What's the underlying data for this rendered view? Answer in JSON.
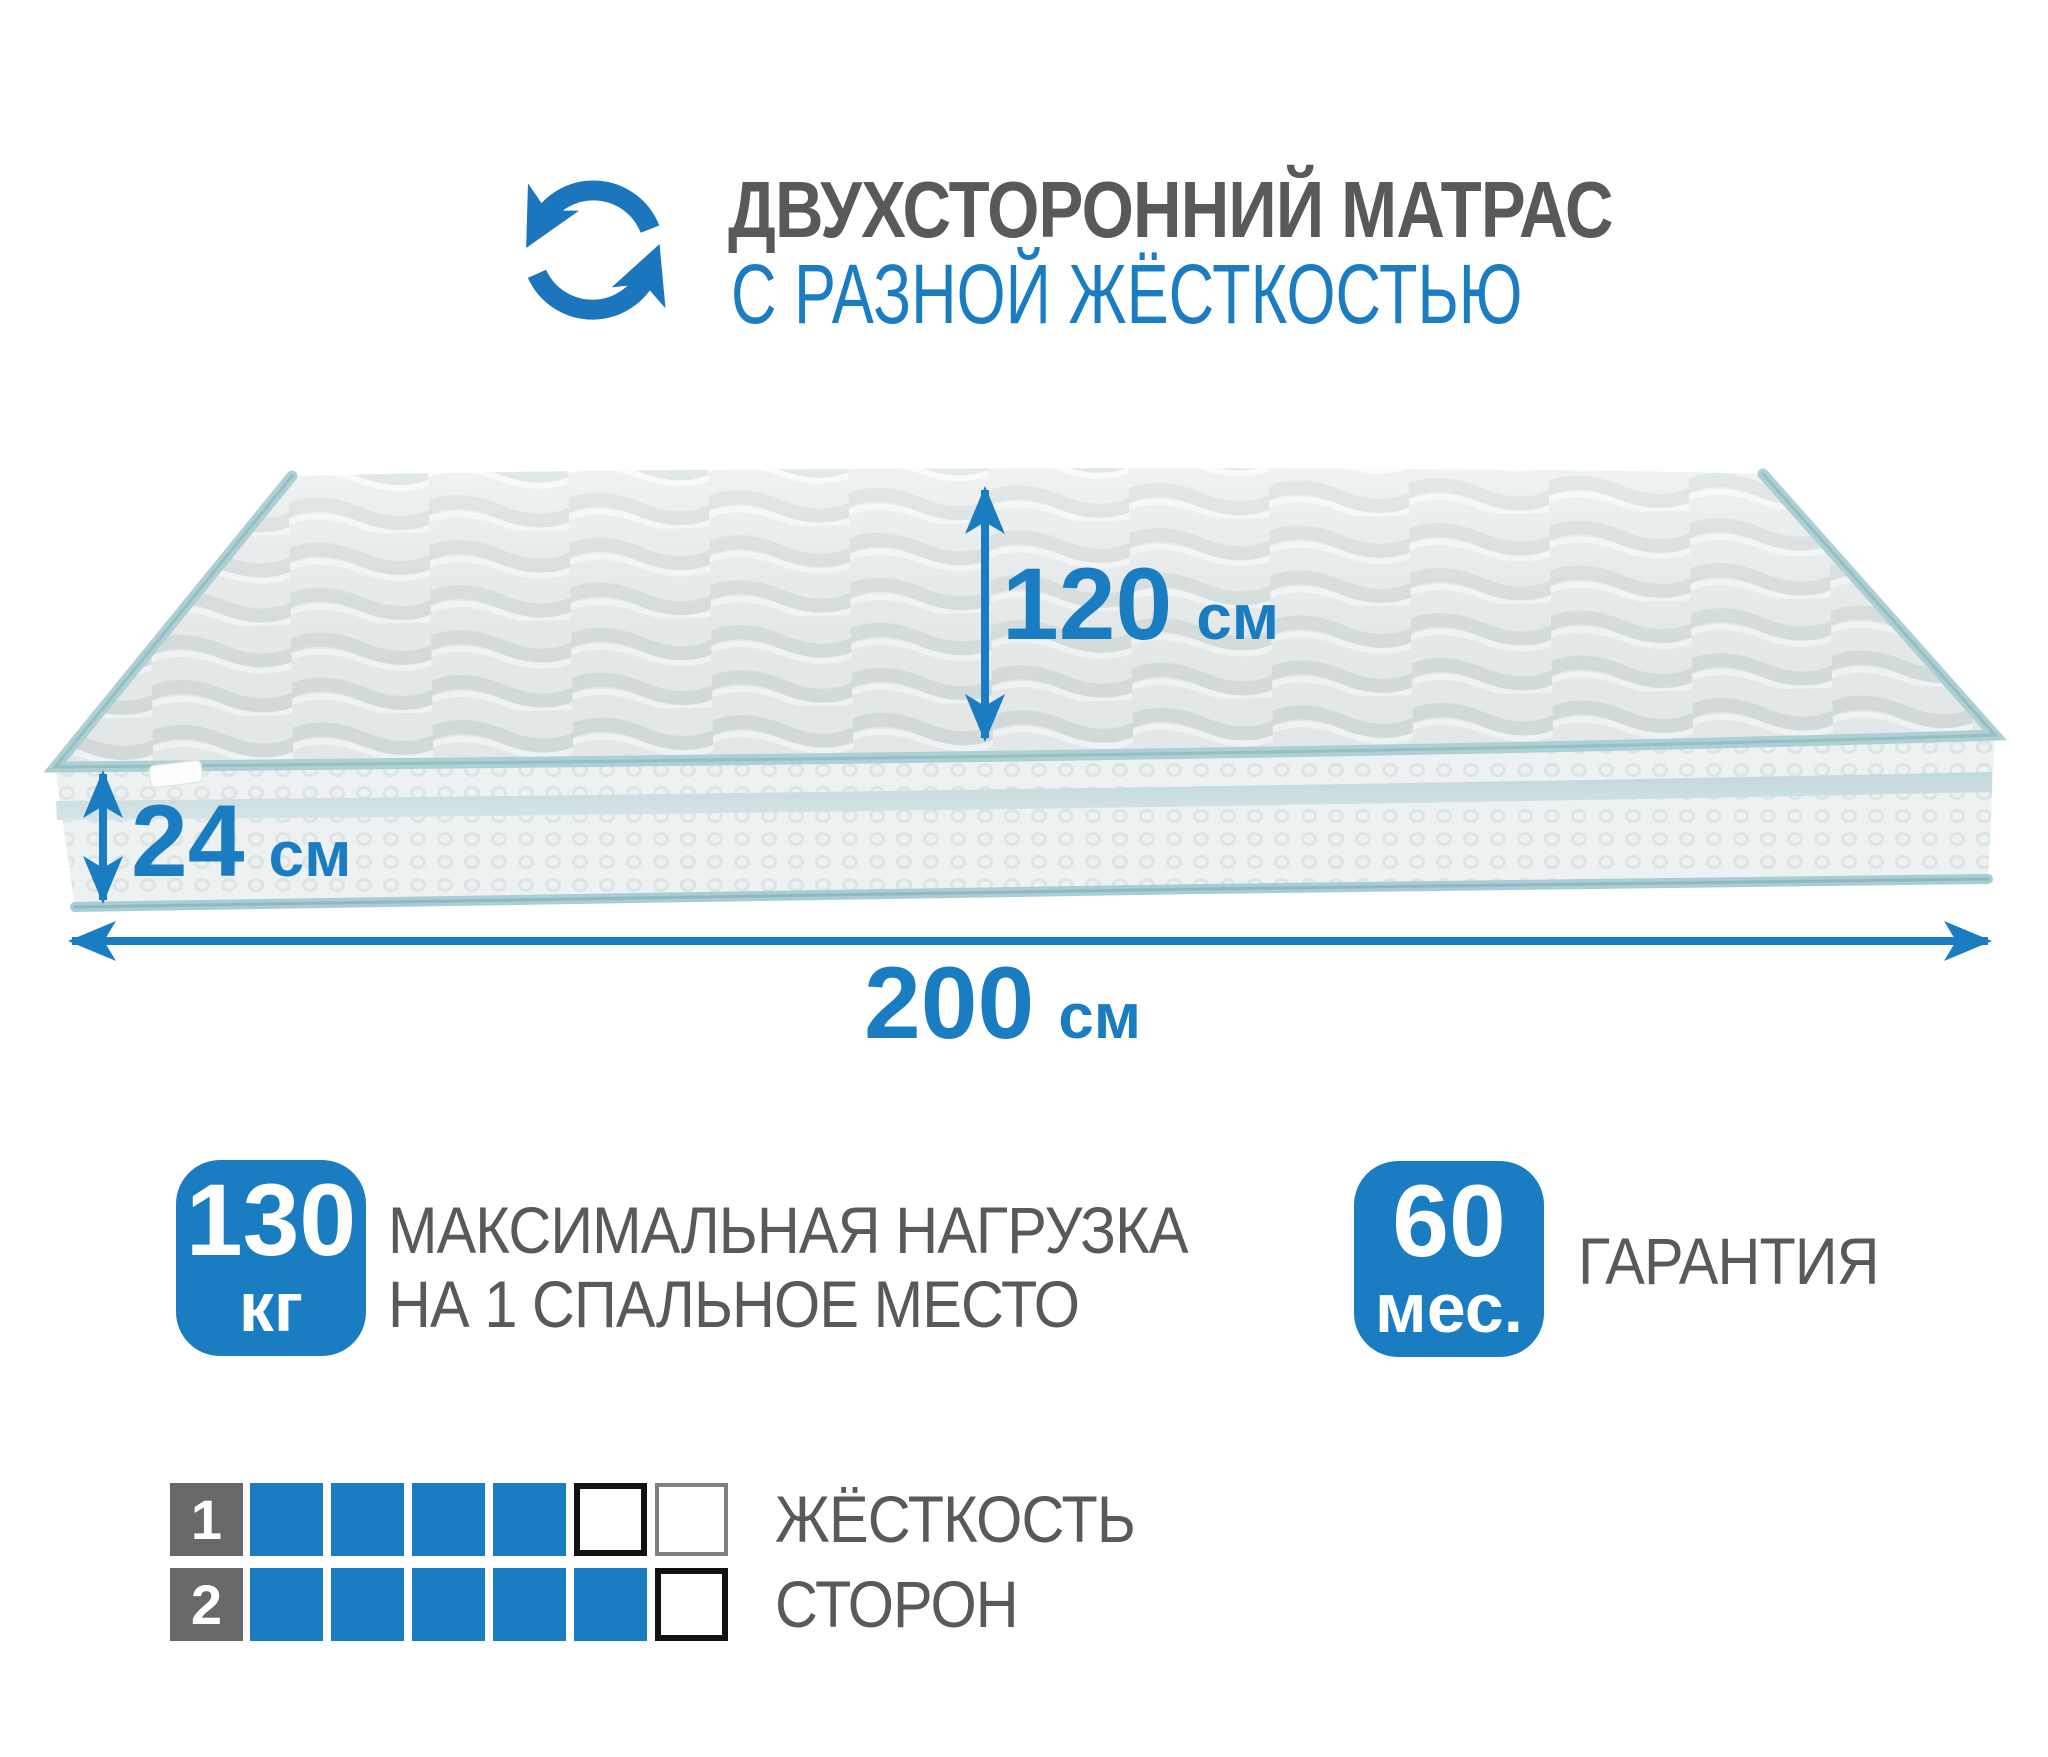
{
  "header": {
    "title": "ДВУХСТОРОННИЙ МАТРАС",
    "subtitle": "С РАЗНОЙ ЖЁСТКОСТЬЮ"
  },
  "dimensions": {
    "width": {
      "value": "120",
      "unit": "см"
    },
    "height": {
      "value": "24",
      "unit": "см"
    },
    "length": {
      "value": "200",
      "unit": "см"
    }
  },
  "features": {
    "max_load": {
      "value": "130",
      "unit": "кг",
      "label_line1": "МАКСИМАЛЬНАЯ НАГРУЗКА",
      "label_line2": "НА 1 СПАЛЬНОЕ МЕСТО"
    },
    "warranty": {
      "value": "60",
      "unit": "мес.",
      "label": "ГАРАНТИЯ"
    }
  },
  "firmness": {
    "legend_line1": "ЖЁСТКОСТЬ",
    "legend_line2": "СТОРОН",
    "scale_max": 6,
    "rows": [
      {
        "label": "1",
        "filled": 4,
        "cells": [
          "filled",
          "filled",
          "filled",
          "filled",
          "empty",
          "empty-light"
        ]
      },
      {
        "label": "2",
        "filled": 5,
        "cells": [
          "filled",
          "filled",
          "filled",
          "filled",
          "filled",
          "empty"
        ]
      }
    ]
  },
  "colors": {
    "accent_blue": "#1b7dc1",
    "text_gray": "#58595b",
    "cell_dark_gray": "#676869",
    "empty_border_black": "#111111",
    "empty_border_gray": "#7e7f80",
    "piping_teal": "#aed0d3",
    "fabric_light": "#e9ecec"
  }
}
